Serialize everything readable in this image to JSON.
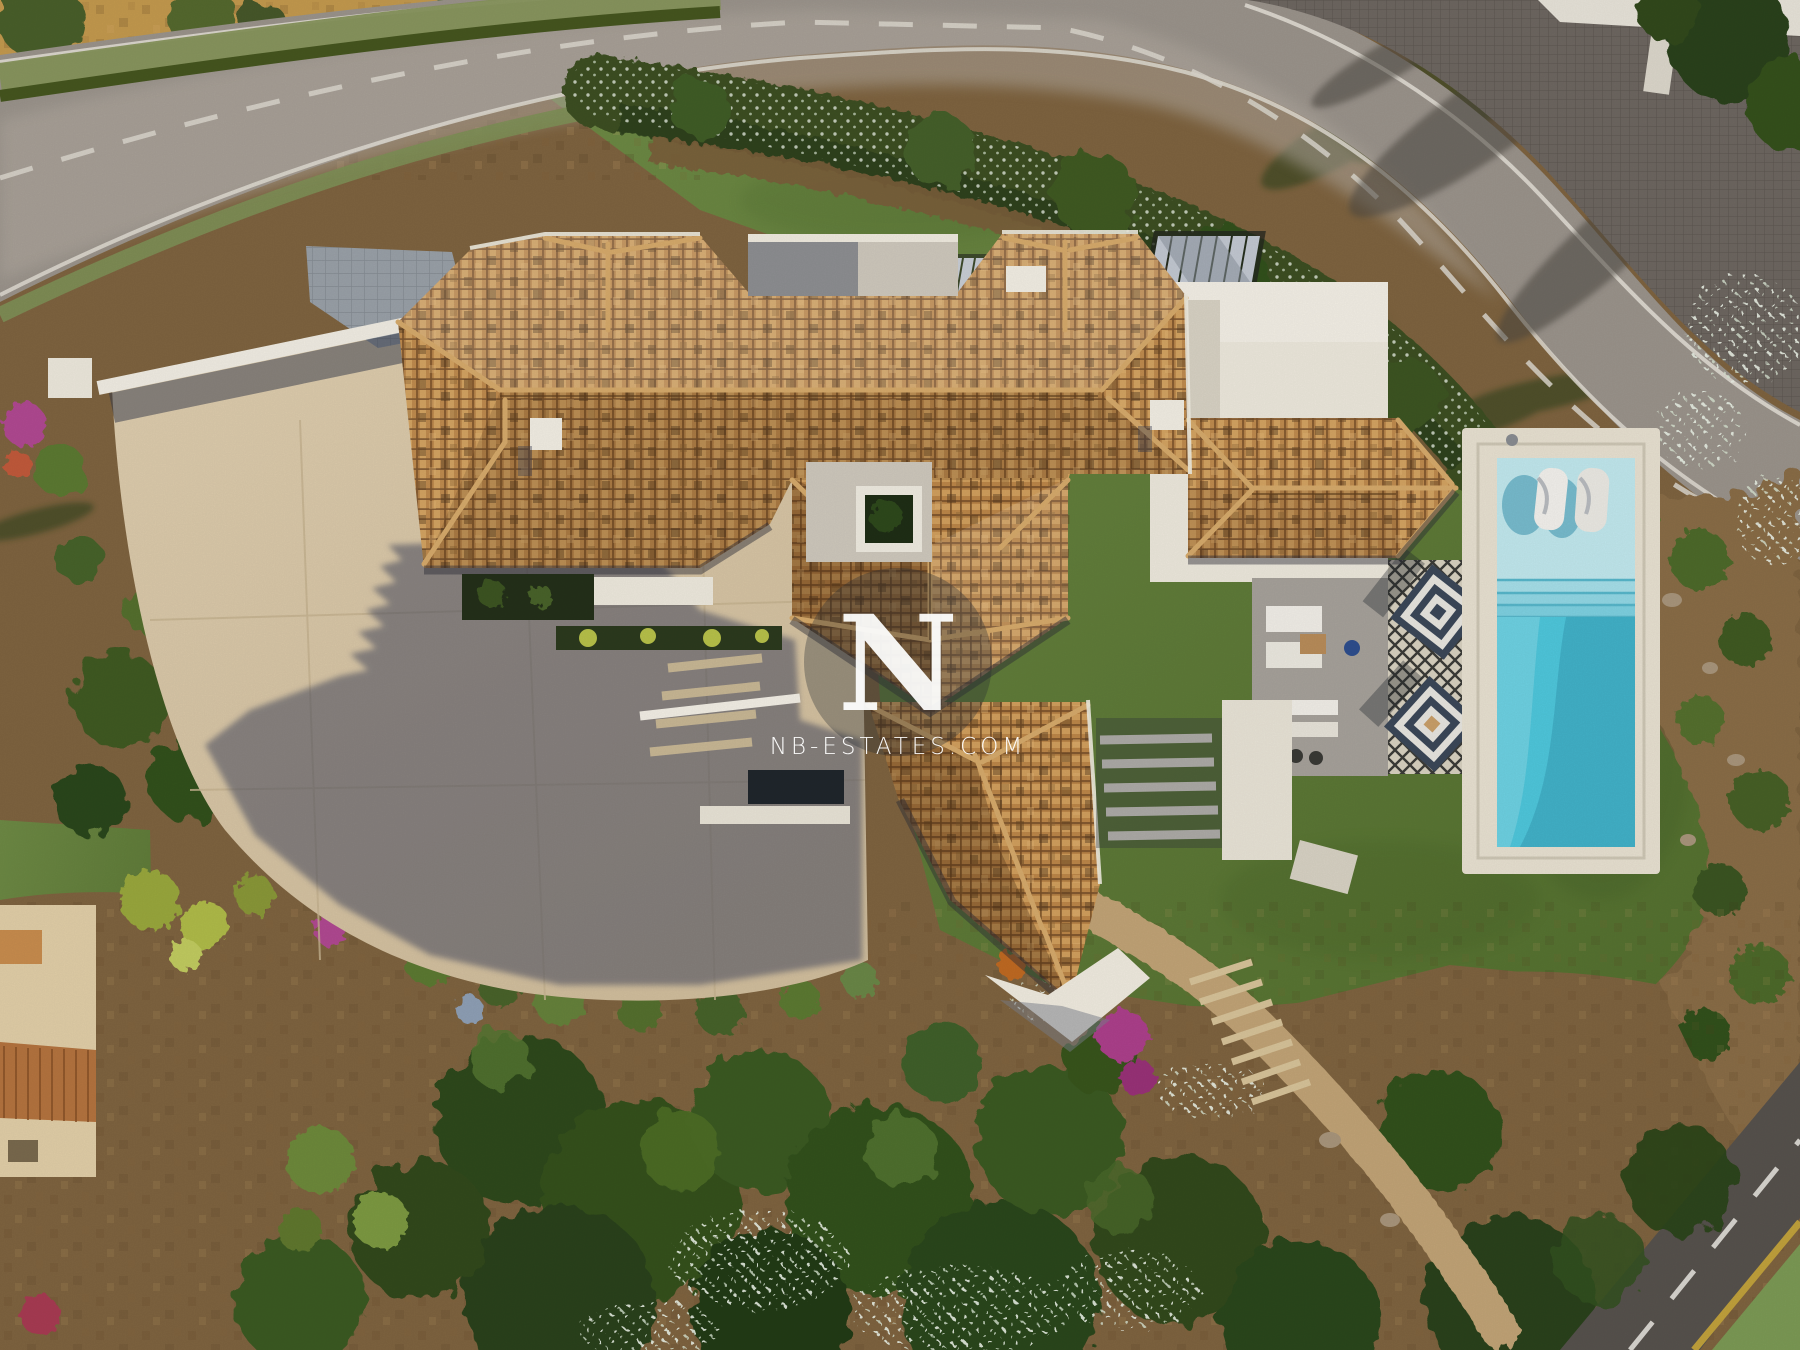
{
  "watermark": {
    "logo_letter": "N",
    "site_text": "NB-ESTATES.COM",
    "text_color": "#ffffff",
    "circle_color": "#272b33"
  },
  "palette": {
    "asphalt": "#9b948c",
    "asphalt_dark": "#57524d",
    "road_line": "#e3ded5",
    "dry_field": "#c49a4e",
    "verge_green": "#87955c",
    "hedge_green": "#3d5023",
    "lawn": "#66833e",
    "lawn_deep": "#4d6a2f",
    "driveway": "#d9c7a7",
    "cast_shadow": "#474c61",
    "roof_tile": "#c08c4f",
    "roof_tile_shade": "#7d5630",
    "white_wall": "#f1ece0",
    "terrace_grey": "#a7a29b",
    "court_grey": "#cfc9bd",
    "pool_deck": "#e9e2d2",
    "pool_shelf": "#c2e9ef",
    "pool_steps": "#8ed8e5",
    "pool_water": "#4fc8dd",
    "umbrella_navy": "#3c4859",
    "wood": "#a87c48",
    "cobble": "#6e6761",
    "soil": "#7f6440",
    "tree_dark": "#33511f",
    "tree_light": "#517229",
    "flower_white": "#e4ecdc",
    "bougainvillea": "#ad3f8c",
    "orange_flower": "#cf7a2a",
    "neighbor_roof": "#b5743f",
    "yellow_line": "#c2a23c",
    "bike_lane": "#7c9a55"
  }
}
